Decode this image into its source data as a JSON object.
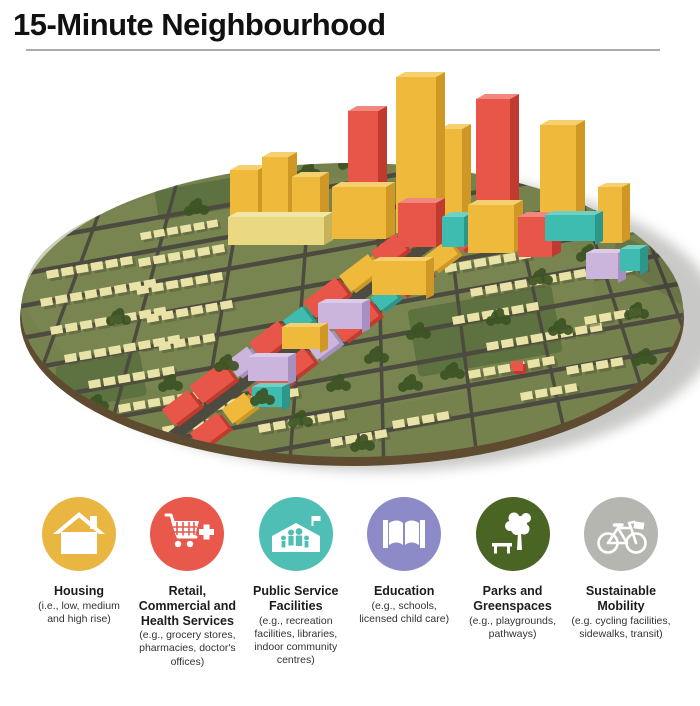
{
  "title": "15-Minute Neighbourhood",
  "model": {
    "description": "3D rendering of a circular 15-minute neighbourhood: low-rise houses around a mixed-use main street corridor with a high-rise downtown cluster, parks and trees, colour-coded by land use",
    "colors": {
      "low_rise_housing": "#EAE3A8",
      "retail_commercial_health": "#E8564A",
      "offices_high_rise": "#EFB93C",
      "public_service": "#3FBCB0",
      "education": "#CBB5DD",
      "greenspace": "#75824E",
      "streets": "#4D4A40",
      "base_rim": "#5E4B30"
    }
  },
  "legend": {
    "items": [
      {
        "id": "housing",
        "label": "Housing",
        "sublabel": "(i.e., low, medium and high rise)",
        "color": "#E9B642",
        "icon": "house-icon"
      },
      {
        "id": "retail-commercial-health",
        "label": "Retail, Commercial and Health Services",
        "sublabel": "(e.g., grocery stores, pharmacies, doctor's offices)",
        "color": "#E8594C",
        "icon": "shopping-cart-plus-icon"
      },
      {
        "id": "public-service",
        "label": "Public Service Facilities",
        "sublabel": "(e.g., recreation facilities, libraries, indoor community centres)",
        "color": "#4FBEB4",
        "icon": "community-centre-icon"
      },
      {
        "id": "education",
        "label": "Education",
        "sublabel": "(e.g., schools, licensed child care)",
        "color": "#8C8BC8",
        "icon": "open-book-icon"
      },
      {
        "id": "parks-greenspaces",
        "label": "Parks and Greenspaces",
        "sublabel": "(e.g., playgrounds, pathways)",
        "color": "#4A6424",
        "icon": "tree-bench-icon"
      },
      {
        "id": "sustainable-mobility",
        "label": "Sustainable Mobility",
        "sublabel": "(e.g. cycling facilities, sidewalks, transit)",
        "color": "#B4B6AF",
        "icon": "bicycle-icon"
      }
    ]
  }
}
